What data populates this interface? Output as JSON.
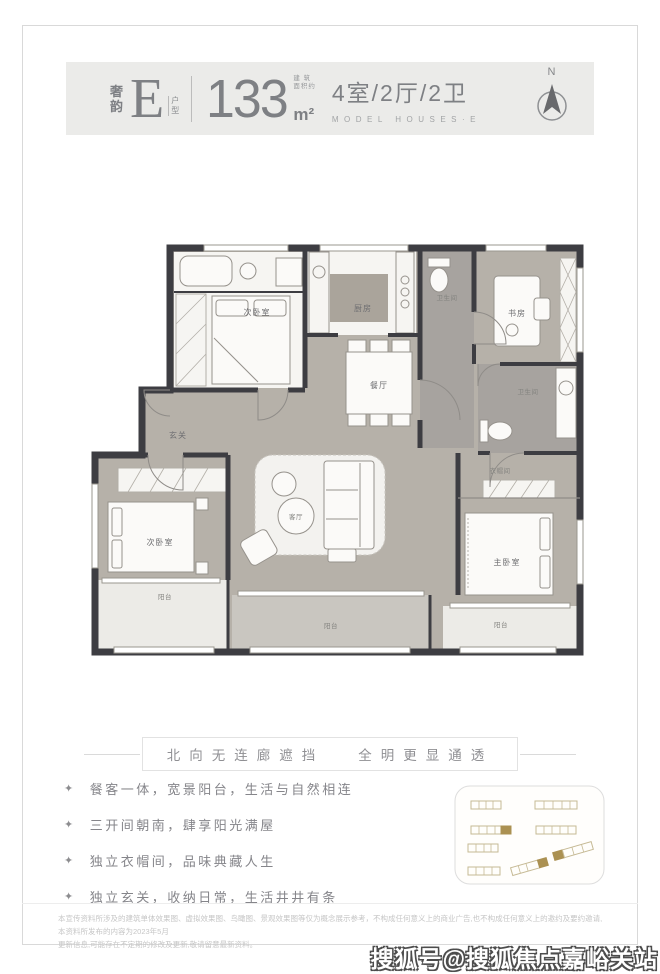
{
  "header": {
    "series_cn": "奢韵",
    "series_cn_1": "奢",
    "series_cn_2": "韵",
    "type_letter": "E",
    "type_label_1": "户",
    "type_label_2": "型",
    "area_value": "133",
    "area_note_top": "建 筑",
    "area_note_bottom": "面积约",
    "area_unit": "m²",
    "layout": "4室/2厅/2卫",
    "subtitle_en": "MODEL HOUSES·E",
    "compass_label": "N"
  },
  "floorplan": {
    "rooms": {
      "bedroom_top_left": "次卧室",
      "kitchen": "厨房",
      "study": "书房",
      "bath_corridor": "卫生间",
      "bath_master": "卫生间",
      "foyer": "玄关",
      "dining": "餐厅",
      "living": "客厅",
      "bedroom_bottom_left": "次卧室",
      "master_bedroom": "主卧室",
      "cloakroom": "衣帽间",
      "balcony_center": "阳台",
      "balcony_left": "阳台",
      "balcony_right": "阳台"
    }
  },
  "tagline": {
    "left": "北向无连廊遮挡",
    "right": "全明更显通透"
  },
  "features": {
    "bullet": "✦",
    "items": [
      "餐客一体，宽景阳台，生活与自然相连",
      "三开间朝南，肆享阳光满屋",
      "独立衣帽间，品味典藏人生",
      "独立玄关，收纳日常，生活井井有条"
    ]
  },
  "disclaimer": {
    "line1": "本宣传资料所涉及的建筑单体效果图、虚拟效果图、鸟瞰图、景观效果图等仅为概念展示参考，不构成任何意义上的商业广告,也不构成任何意义上的邀约及要约邀请,本资料所发布的内容为2023年5月",
    "line2": "更新信息,可能存在不定期的修改及更新,敬请留意最新资料。"
  },
  "watermark": "搜狐号@搜狐焦点嘉峪关站",
  "colors": {
    "wall": "#3d3d42",
    "floor_taupe": "#b6b1a9",
    "floor_light": "#f6f5f2",
    "floor_gray": "#a7a39f",
    "balcony": "#c9c6c0",
    "header_text": "#7e8084",
    "accent_gold": "#ab9152",
    "outline_tan": "#c6ba95"
  }
}
